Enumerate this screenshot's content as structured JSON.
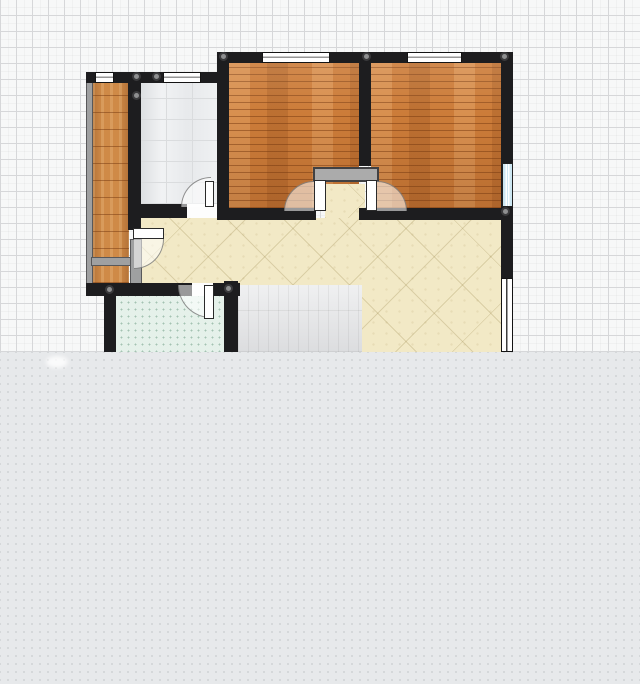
{
  "canvas": {
    "width": 640,
    "height": 684,
    "plan_visible_height": 352
  },
  "colors": {
    "grid_background": "#f7f8f8",
    "grid_major_line": "#d6d7d9",
    "unrendered_overlay": "#e7e9eb",
    "overlay_dot": "#d2d5d7",
    "wall_black": "#1d1d1f",
    "wall_gray": "#9fa0a1",
    "niche_gray": "#ababab",
    "wood_bedroom": "#cc7c39",
    "wood_balcony": "#cf8a47",
    "tile_bathroom": "#edeff1",
    "tile_hallway": "#f2e9c6",
    "tile_kitchen": "#e5f1ea",
    "tile_gray_area": "#e3e4e6",
    "window_white": "#ffffff",
    "window_blue": "#cde7f2"
  },
  "plan": {
    "elements": [
      {
        "name": "grid-background",
        "type": "grid-bg",
        "x": 0,
        "y": 0,
        "w": 640,
        "h": 352,
        "i": false
      },
      {
        "name": "balcony-floor",
        "type": "floor-wood-v",
        "x": 92,
        "y": 83,
        "w": 37,
        "h": 200,
        "i": true
      },
      {
        "name": "bathroom-floor",
        "type": "floor-tile-bath",
        "x": 140,
        "y": 83,
        "w": 78,
        "h": 121,
        "i": true
      },
      {
        "name": "bedroom-left-floor",
        "type": "floor-wood-h",
        "x": 229,
        "y": 63,
        "w": 130,
        "h": 145,
        "i": true,
        "shade": true
      },
      {
        "name": "bedroom-right-floor",
        "type": "floor-wood-h",
        "x": 371,
        "y": 63,
        "w": 130,
        "h": 145,
        "i": true,
        "shade": true
      },
      {
        "name": "hallway-floor",
        "type": "floor-tile-hall",
        "x": 133,
        "y": 218,
        "w": 369,
        "h": 134,
        "i": true,
        "clip": "polygon(0 0, 369px 0, 369px 134px, 229px 134px, 229px 67px, 0 67px)"
      },
      {
        "name": "alcove-floor",
        "type": "floor-tile-hall",
        "x": 325,
        "y": 184,
        "w": 40,
        "h": 34,
        "i": true
      },
      {
        "name": "kitchen-floor",
        "type": "floor-tile-kitchen",
        "x": 115,
        "y": 296,
        "w": 109,
        "h": 56,
        "i": true
      },
      {
        "name": "dining-area-floor",
        "type": "floor-tile-gray",
        "x": 238,
        "y": 285,
        "w": 124,
        "h": 67,
        "i": true
      },
      {
        "name": "balcony-outer-wall",
        "type": "wall-gray",
        "x": 86,
        "y": 72,
        "w": 7,
        "h": 224,
        "i": true
      },
      {
        "name": "balcony-divider-wall",
        "type": "wall-gray",
        "x": 91,
        "y": 257,
        "w": 40,
        "h": 9,
        "i": true
      },
      {
        "name": "balcony-side-wall",
        "type": "wall-gray",
        "x": 130,
        "y": 239,
        "w": 12,
        "h": 46,
        "i": true
      },
      {
        "name": "wall-top-bedrooms",
        "type": "wall-black",
        "x": 217,
        "y": 52,
        "w": 296,
        "h": 11,
        "i": true
      },
      {
        "name": "wall-top-left-section",
        "type": "wall-black",
        "x": 86,
        "y": 72,
        "w": 143,
        "h": 11,
        "i": true
      },
      {
        "name": "wall-balcony-right",
        "type": "wall-black",
        "x": 128,
        "y": 72,
        "w": 13,
        "h": 158,
        "i": true
      },
      {
        "name": "wall-bathroom-right",
        "type": "wall-black",
        "x": 217,
        "y": 52,
        "w": 12,
        "h": 166,
        "i": true
      },
      {
        "name": "wall-bedroom-separator",
        "type": "wall-black",
        "x": 359,
        "y": 52,
        "w": 12,
        "h": 114,
        "i": true
      },
      {
        "name": "wall-right-exterior",
        "type": "wall-black",
        "x": 501,
        "y": 52,
        "w": 12,
        "h": 301,
        "i": true
      },
      {
        "name": "wall-bathroom-bottom",
        "type": "wall-black",
        "x": 133,
        "y": 204,
        "w": 54,
        "h": 14,
        "i": true
      },
      {
        "name": "wall-bedroom-left-bottom",
        "type": "wall-black",
        "x": 217,
        "y": 208,
        "w": 99,
        "h": 12,
        "i": true
      },
      {
        "name": "wall-bedroom-right-bottom",
        "type": "wall-black",
        "x": 359,
        "y": 208,
        "w": 153,
        "h": 12,
        "i": true
      },
      {
        "name": "wall-kitchen-top",
        "type": "wall-black",
        "x": 86,
        "y": 283,
        "w": 106,
        "h": 13,
        "i": true
      },
      {
        "name": "wall-kitchen-top-stub",
        "type": "wall-black",
        "x": 213,
        "y": 283,
        "w": 27,
        "h": 13,
        "i": true
      },
      {
        "name": "wall-kitchen-left",
        "type": "wall-black",
        "x": 104,
        "y": 296,
        "w": 12,
        "h": 57,
        "i": true
      },
      {
        "name": "wall-kitchen-right",
        "type": "wall-black",
        "x": 224,
        "y": 281,
        "w": 14,
        "h": 72,
        "i": true
      },
      {
        "name": "alcove-niche-wall",
        "type": "wall-gray-dark",
        "x": 313,
        "y": 167,
        "w": 66,
        "h": 15,
        "i": true
      },
      {
        "name": "window-balcony",
        "type": "window-h",
        "x": 95,
        "y": 72,
        "w": 19,
        "h": 11,
        "i": true
      },
      {
        "name": "window-bathroom",
        "type": "window-h",
        "x": 163,
        "y": 72,
        "w": 38,
        "h": 11,
        "i": true
      },
      {
        "name": "window-bedroom-left",
        "type": "window-h",
        "x": 262,
        "y": 52,
        "w": 68,
        "h": 11,
        "i": true
      },
      {
        "name": "window-bedroom-right",
        "type": "window-h",
        "x": 407,
        "y": 52,
        "w": 55,
        "h": 11,
        "i": true
      },
      {
        "name": "window-bedroom-right-side",
        "type": "window-v-blue",
        "x": 502,
        "y": 163,
        "w": 11,
        "h": 44,
        "i": true
      },
      {
        "name": "window-living-side",
        "type": "window-v-white",
        "x": 501,
        "y": 278,
        "w": 12,
        "h": 74,
        "i": true
      },
      {
        "name": "bathroom-door-opening",
        "type": "door-opening",
        "x": 187,
        "y": 204,
        "w": 30,
        "h": 14,
        "i": false
      },
      {
        "name": "kitchen-door-opening",
        "type": "door-opening",
        "x": 192,
        "y": 283,
        "w": 21,
        "h": 13,
        "i": false
      },
      {
        "name": "bathroom-door-swing",
        "type": "door-swing",
        "corner": "tl",
        "x": 181,
        "y": 177,
        "w": 30,
        "h": 30,
        "i": false
      },
      {
        "name": "balcony-door-swing",
        "type": "door-swing",
        "corner": "br",
        "x": 134,
        "y": 239,
        "w": 30,
        "h": 30,
        "i": false
      },
      {
        "name": "kitchen-door-swing",
        "type": "door-swing",
        "corner": "bl",
        "x": 178,
        "y": 285,
        "w": 33,
        "h": 33,
        "i": false
      },
      {
        "name": "bedroom-left-door-swing",
        "type": "door-swing",
        "corner": "tl",
        "x": 284,
        "y": 181,
        "w": 30,
        "h": 30,
        "i": false
      },
      {
        "name": "bedroom-right-door-swing",
        "type": "door-swing",
        "corner": "tr",
        "x": 377,
        "y": 181,
        "w": 30,
        "h": 30,
        "i": false
      },
      {
        "name": "bathroom-door-panel",
        "type": "door-panel",
        "x": 205,
        "y": 181,
        "w": 9,
        "h": 26,
        "i": true
      },
      {
        "name": "balcony-door-panel",
        "type": "door-panel",
        "x": 133,
        "y": 228,
        "w": 31,
        "h": 11,
        "i": true
      },
      {
        "name": "kitchen-door-panel",
        "type": "door-panel",
        "x": 204,
        "y": 285,
        "w": 10,
        "h": 34,
        "i": true
      },
      {
        "name": "bedroom-left-door-panel",
        "type": "door-panel",
        "x": 314,
        "y": 180,
        "w": 12,
        "h": 31,
        "i": true
      },
      {
        "name": "bedroom-right-door-panel",
        "type": "door-panel",
        "x": 366,
        "y": 180,
        "w": 11,
        "h": 31,
        "i": true
      },
      {
        "name": "wall-joint",
        "type": "joint",
        "x": 132,
        "y": 72,
        "w": 9,
        "h": 9,
        "i": true
      },
      {
        "name": "wall-joint",
        "type": "joint",
        "x": 152,
        "y": 72,
        "w": 9,
        "h": 9,
        "i": true
      },
      {
        "name": "wall-joint",
        "type": "joint",
        "x": 132,
        "y": 91,
        "w": 9,
        "h": 9,
        "i": true
      },
      {
        "name": "wall-joint",
        "type": "joint",
        "x": 219,
        "y": 52,
        "w": 9,
        "h": 9,
        "i": true
      },
      {
        "name": "wall-joint",
        "type": "joint",
        "x": 362,
        "y": 52,
        "w": 9,
        "h": 9,
        "i": true
      },
      {
        "name": "wall-joint",
        "type": "joint",
        "x": 500,
        "y": 52,
        "w": 9,
        "h": 9,
        "i": true
      },
      {
        "name": "wall-joint",
        "type": "joint",
        "x": 501,
        "y": 207,
        "w": 9,
        "h": 9,
        "i": true
      },
      {
        "name": "wall-joint",
        "type": "joint",
        "x": 105,
        "y": 285,
        "w": 9,
        "h": 9,
        "i": true
      },
      {
        "name": "wall-joint",
        "type": "joint",
        "x": 224,
        "y": 284,
        "w": 9,
        "h": 9,
        "i": true
      },
      {
        "name": "unrendered-area-overlay",
        "type": "overlay-bottom",
        "x": 0,
        "y": 352,
        "w": 640,
        "h": 332,
        "i": false
      },
      {
        "name": "overlay-smudge",
        "type": "smudge",
        "x": 46,
        "y": 356,
        "w": 22,
        "h": 12,
        "i": false
      }
    ]
  }
}
